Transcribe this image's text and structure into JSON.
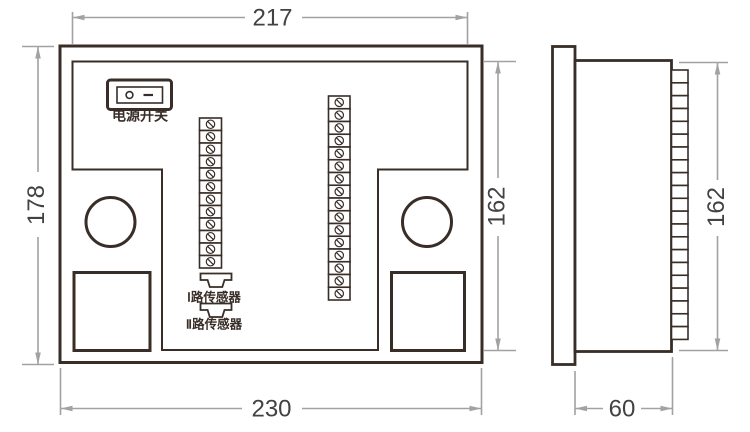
{
  "drawing": {
    "back_view": {
      "power_switch_label": "电源开关",
      "sensor1_label": "Ⅰ路传感器",
      "sensor2_label": "Ⅱ路传感器",
      "left_strip": {
        "count": 12,
        "x": 199.5,
        "y": 118,
        "cell_w": 22,
        "cell_h": 12.5,
        "screw": true
      },
      "right_strip": {
        "count": 16,
        "x": 328.5,
        "y": 96,
        "cell_w": 21.5,
        "cell_h": 12.75,
        "screw": true
      }
    },
    "side_view": {
      "ladder": {
        "count": 21,
        "x": 671.5,
        "y": 70,
        "cell_w": 16.5,
        "cell_h": 12.83,
        "screw": false
      }
    },
    "dimensions": {
      "top_width": "217",
      "left_height": "178",
      "inner_height_back": "162",
      "bottom_width": "230",
      "side_depth": "60",
      "inner_height_side": "162"
    },
    "colors": {
      "outline": "#382d27",
      "dimension_line": "#a2a2a2",
      "dimension_text": "#424242",
      "background": "#ffffff"
    }
  }
}
